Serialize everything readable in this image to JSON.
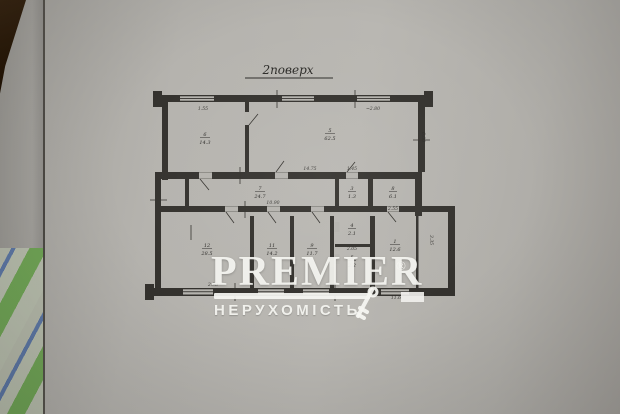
{
  "title": "2поверх",
  "watermark": {
    "brand": "PREMIER",
    "reg": "®",
    "subtitle": "НЕРУХОМІСТЬ"
  },
  "rooms": [
    {
      "num": "6",
      "area": "14.3"
    },
    {
      "num": "5",
      "area": "62.5"
    },
    {
      "num": "7",
      "area": "24.7"
    },
    {
      "num": "3",
      "area": "1.3"
    },
    {
      "num": "8",
      "area": "6.1"
    },
    {
      "num": "12",
      "area": "28.5"
    },
    {
      "num": "11",
      "area": "14.2"
    },
    {
      "num": "9",
      "area": "11.7"
    },
    {
      "num": "4",
      "area": "2.1"
    },
    {
      "num": "5",
      "area": "2.2"
    },
    {
      "num": "1",
      "area": "12.6"
    }
  ],
  "dims": {
    "d155": "1.55",
    "d280": "~2.80",
    "d600": "6.00",
    "d1475": "14.75",
    "d1090": "10.90",
    "d145": "1.45",
    "d255": "2.55",
    "d205": "2.05",
    "d298": "2.98",
    "d335": "3.35",
    "d116": "11.6"
  }
}
